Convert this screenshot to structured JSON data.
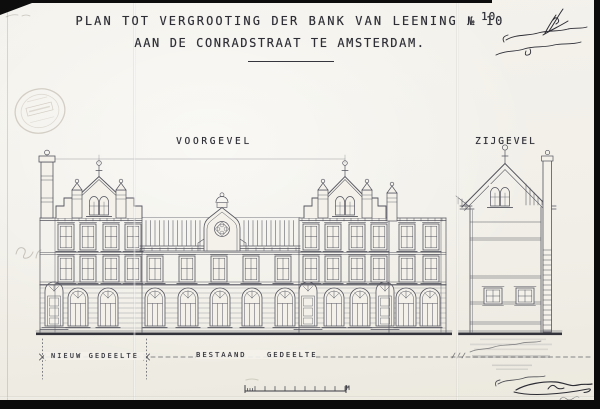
{
  "sheet": {
    "number": "10",
    "title_line1": "PLAN TOT VERGROOTING DER BANK VAN LEENING № 10",
    "title_line2": "AAN DE CONRADSTRAAT TE AMSTERDAM.",
    "front_elevation_label": "VOORGEVEL",
    "side_elevation_label": "ZIJGEVEL",
    "new_section_label": "NIEUW GEDEELTE",
    "existing_section_label": "BESTAAND GEDEELTE",
    "scale_unit_label": "M",
    "colors": {
      "ink": "#2e2e36",
      "paper": "#f3f1ea",
      "drawing_line": "#54545f"
    }
  }
}
